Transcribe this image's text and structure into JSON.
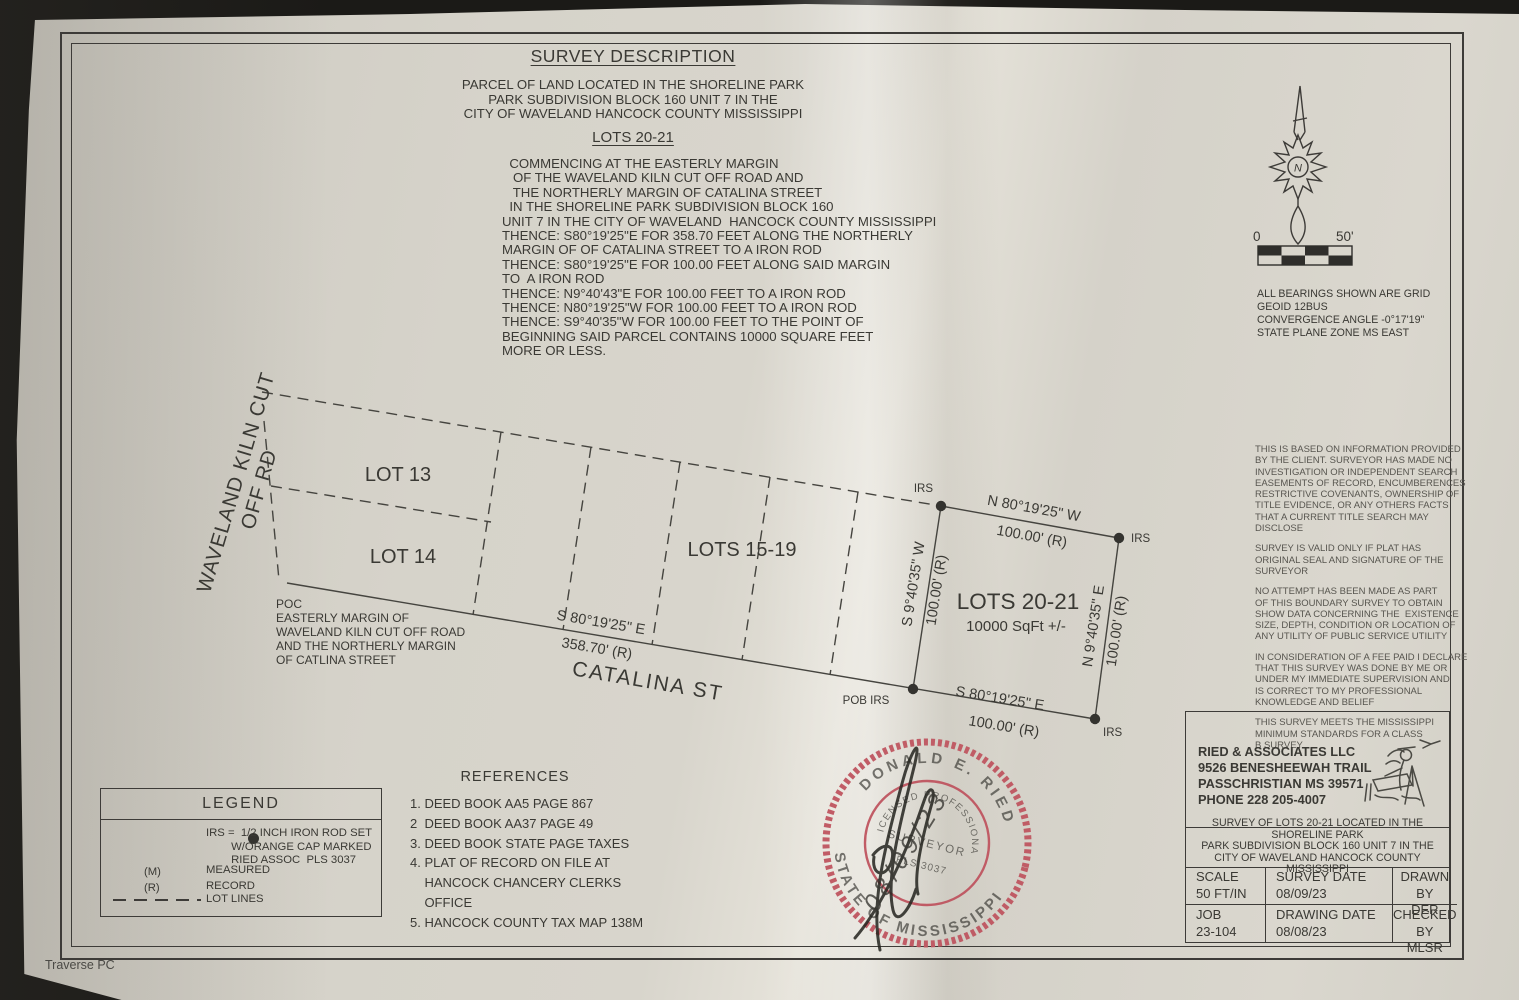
{
  "colors": {
    "ink": "#3a3934",
    "seal_red": "#bf5560",
    "paper": "#d6d3ca"
  },
  "header": {
    "title": "SURVEY DESCRIPTION",
    "location": "PARCEL OF LAND LOCATED IN THE SHORELINE PARK\nPARK SUBDIVISION BLOCK 160 UNIT 7 IN THE\nCITY OF WAVELAND HANCOCK COUNTY MISSISSIPPI",
    "lots_heading": "LOTS 20-21",
    "body": "  COMMENCING AT THE EASTERLY MARGIN\n   OF THE WAVELAND KILN CUT OFF ROAD AND\n   THE NORTHERLY MARGIN OF CATALINA STREET\n  IN THE SHORELINE PARK SUBDIVISION BLOCK 160\nUNIT 7 IN THE CITY OF WAVELAND  HANCOCK COUNTY MISSISSIPPI\nTHENCE: S80°19'25\"E FOR 358.70 FEET ALONG THE NORTHERLY\nMARGIN OF OF CATALINA STREET TO A IRON ROD\nTHENCE: S80°19'25\"E FOR 100.00 FEET ALONG SAID MARGIN\nTO  A IRON ROD\nTHENCE: N9°40'43\"E FOR 100.00 FEET TO A IRON ROD\nTHENCE: N80°19'25\"W FOR 100.00 FEET TO A IRON ROD\nTHENCE: S9°40'35\"W FOR 100.00 FEET TO THE POINT OF\nBEGINNING SAID PARCEL CONTAINS 10000 SQUARE FEET\nMORE OR LESS."
  },
  "compass": {
    "n": "N"
  },
  "scalebar": {
    "zero": "0",
    "fifty": "50'"
  },
  "grid_notes": {
    "text": "ALL BEARINGS SHOWN ARE GRID\nGEOID 12BUS\nCONVERGENCE ANGLE -0°17'19\"\nSTATE PLANE ZONE MS EAST"
  },
  "plat": {
    "road_label": "WAVELAND KILN CUT OFF RD",
    "street": "CATALINA ST",
    "poc_note": "POC\nEASTERLY MARGIN OF\nWAVELAND KILN CUT OFF ROAD\nAND THE NORTHERLY MARGIN\nOF CATLINA STREET",
    "lot13": "LOT 13",
    "lot14": "LOT 14",
    "lots1519": "LOTS 15-19",
    "lots2021": "LOTS 20-21",
    "area": "10000 SqFt +/-",
    "south_bearing": "S 80°19'25\" E",
    "south_distance": "358.70' (R)",
    "parcel": {
      "north_bearing": "N 80°19'25\" W",
      "north_distance": "100.00' (R)",
      "south_bearing": "S 80°19'25\" E",
      "south_distance": "100.00' (R)",
      "west_bearing": "S 9°40'35\" W",
      "west_distance": "100.00' (R)",
      "east_bearing": "N 9°40'35\" E",
      "east_distance": "100.00' (R)"
    },
    "markers": {
      "irs": "IRS",
      "pob": "POB IRS"
    }
  },
  "notes": {
    "paragraphs": [
      "THIS IS BASED ON INFORMATION PROVIDED\nBY THE CLIENT. SURVEYOR HAS MADE NO\nINVESTIGATION OR INDEPENDENT SEARCH\nEASEMENTS OF RECORD, ENCUMBERENCES\nRESTRICTIVE COVENANTS, OWNERSHIP OF\nTITLE EVIDENCE, OR ANY OTHERS FACTS\nTHAT A CURRENT TITLE SEARCH MAY\nDISCLOSE",
      "SURVEY IS VALID ONLY IF PLAT HAS\nORIGINAL SEAL AND SIGNATURE OF THE\nSURVEYOR",
      "NO ATTEMPT HAS BEEN MADE AS PART\nOF THIS BOUNDARY SURVEY TO OBTAIN\nSHOW DATA CONCERNING THE  EXISTENCE\nSIZE, DEPTH, CONDITION OR LOCATION OF\nANY UTILITY OF PUBLIC SERVICE UTILITY",
      "IN CONSIDERATION OF A FEE PAID I DECLARE\nTHAT THIS SURVEY WAS DONE BY ME OR\nUNDER MY IMMEDIATE SUPERVISION AND\nIS CORRECT TO MY PROFESSIONAL\nKNOWLEDGE AND BELIEF",
      "THIS SURVEY MEETS THE MISSISSIPPI\nMINIMUM STANDARDS FOR A CLASS\nB SURVEY"
    ]
  },
  "legend": {
    "title": "LEGEND",
    "irs_text": "IRS =  1/2 INCH IRON ROD SET\n        W/ORANGE CAP MARKED\n        RIED ASSOC  PLS 3037",
    "mr_labels": "(M)\n(R)",
    "mr_values": "MEASURED\nRECORD",
    "lotlines_label": "LOT LINES"
  },
  "references": {
    "title": "REFERENCES",
    "items": [
      "1. DEED BOOK AA5 PAGE 867",
      "2  DEED BOOK AA37 PAGE 49",
      "3. DEED BOOK STATE PAGE TAXES",
      "4. PLAT OF RECORD ON FILE AT\n    HANCOCK CHANCERY CLERKS\n    OFFICE",
      "5. HANCOCK COUNTY TAX MAP 138M"
    ]
  },
  "seal": {
    "name_top": "DONALD E. RIED",
    "name_bottom": "STATE OF MISSISSIPPI",
    "inner_top": "LICENSED PROFESSIONAL",
    "inner_mid": "SURVEYOR",
    "license_no": "PLS 3037",
    "date": "08/09/23"
  },
  "titleblock": {
    "firm": [
      "RIED & ASSOCIATES LLC",
      "9526 BENESHEEWAH TRAIL",
      "PASSCHRISTIAN  MS 39571",
      "PHONE 228 205-4007"
    ],
    "survey_title": "SURVEY OF LOTS 20-21 LOCATED IN THE SHORELINE PARK\nPARK SUBDIVISION BLOCK 160 UNIT 7 IN THE\nCITY OF WAVELAND HANCOCK COUNTY MISSISSIPPI",
    "scale_label": "SCALE",
    "scale_value": "50 FT/IN",
    "survey_date_label": "SURVEY DATE",
    "survey_date_value": "08/09/23",
    "drawn_label": "DRAWN BY",
    "drawn_value": "DER",
    "job_label": "JOB",
    "job_value": "23-104",
    "drawing_date_label": "DRAWING DATE",
    "drawing_date_value": "08/08/23",
    "checked_label": "CHECKED BY",
    "checked_value": "MLSR"
  },
  "footer": {
    "text": "Traverse PC"
  }
}
